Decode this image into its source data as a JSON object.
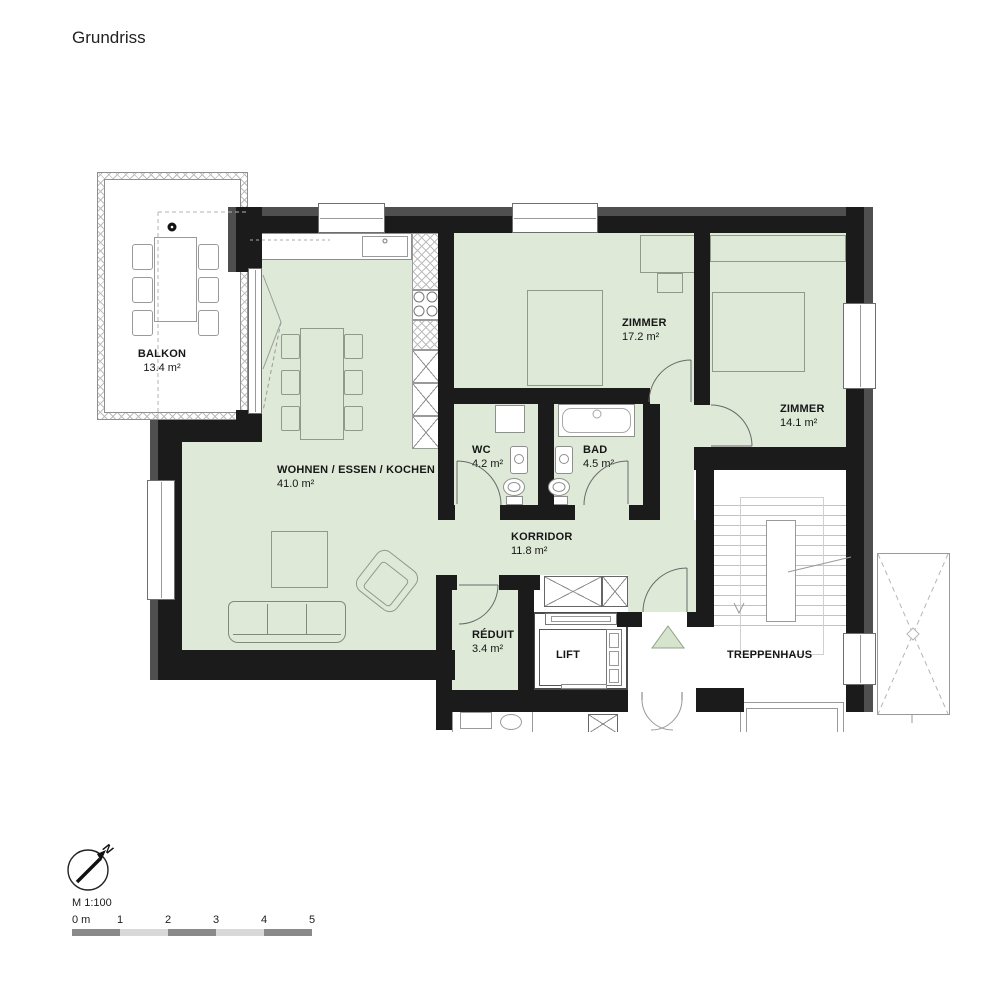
{
  "title": "Grundriss",
  "rooms": {
    "balkon": {
      "name": "BALKON",
      "area": "13.4 m²"
    },
    "wohnen": {
      "name": "WOHNEN / ESSEN / KOCHEN",
      "area": "41.0 m²"
    },
    "zimmer1": {
      "name": "ZIMMER",
      "area": "17.2 m²"
    },
    "zimmer2": {
      "name": "ZIMMER",
      "area": "14.1 m²"
    },
    "wc": {
      "name": "WC",
      "area": "4.2 m²"
    },
    "bad": {
      "name": "BAD",
      "area": "4.5 m²"
    },
    "korridor": {
      "name": "KORRIDOR",
      "area": "11.8 m²"
    },
    "reduit": {
      "name": "RÉDUIT",
      "area": "3.4 m²"
    },
    "lift": {
      "name": "LIFT"
    },
    "treppenhaus": {
      "name": "TREPPENHAUS"
    }
  },
  "compass": {
    "north_label": "N"
  },
  "scalebar": {
    "scale_label": "M 1:100",
    "unit_labels": [
      "0 m",
      "1",
      "2",
      "3",
      "4",
      "5"
    ]
  },
  "colors": {
    "wall": "#1b1b1b",
    "exterior_band": "#4f4f4f",
    "room_fill": "#dfe9d8",
    "entrance_marker": "#d6e3cd",
    "scalebar_dark": "#8a8a8a",
    "scalebar_light": "#d8d8d8"
  }
}
